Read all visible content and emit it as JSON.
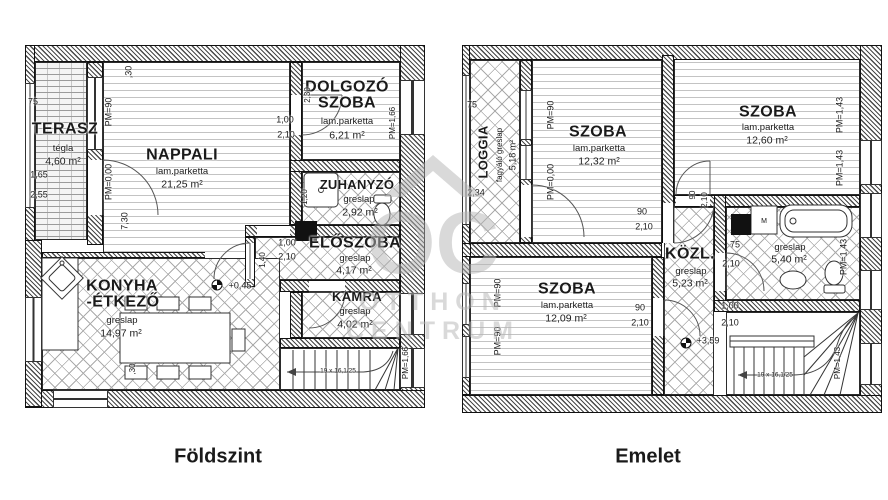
{
  "watermark": {
    "monogram": "OC",
    "line1": "OTTHON",
    "line2": "CENTRUM"
  },
  "floors": [
    {
      "title": "Földszint",
      "rooms": {
        "terasz": {
          "name": "TERASZ",
          "finish": "tégla",
          "area": "4,60 m²"
        },
        "nappali": {
          "name": "NAPPALI",
          "finish": "lam.parketta",
          "area": "21,25 m²"
        },
        "dolgozo": {
          "name1": "DOLGOZÓ",
          "name2": "SZOBA",
          "finish": "lam.parketta",
          "area": "6,21 m²"
        },
        "zuhanyzo": {
          "name": "ZUHANYZÓ",
          "finish": "greslap",
          "area": "2,92 m²"
        },
        "eloszoba": {
          "name": "ELŐSZOBA",
          "finish": "greslap",
          "area": "4,17 m²"
        },
        "kamra": {
          "name": "KAMRA",
          "finish": "greslap",
          "area": "4,02 m²"
        },
        "konyha": {
          "name1": "KONYHA",
          "name2": "-ÉTKEZŐ",
          "finish": "greslap",
          "area": "14,97 m²"
        }
      },
      "dims": {
        "pm90": "PM=90",
        "pm000": "PM=0,00",
        "pm166": "PM=1,66",
        "h730": "7,30",
        "w30": ",30",
        "d100": "1,00",
        "d210": "2,10",
        "d230": "2,30",
        "w120": "1,20",
        "w140": "1,40",
        "t75": "75",
        "t165": "1,65",
        "t255": "2,55",
        "lvl": "+0,45",
        "stair": "19 x 16,1/25"
      }
    },
    {
      "title": "Emelet",
      "rooms": {
        "loggia": {
          "name": "LOGGIA",
          "finish": "fagyáló greslap",
          "area": "5,18 m²"
        },
        "szoba_tl": {
          "name": "SZOBA",
          "finish": "lam.parketta",
          "area": "12,32 m²"
        },
        "szoba_tr": {
          "name": "SZOBA",
          "finish": "lam.parketta",
          "area": "12,60 m²"
        },
        "szoba_bl": {
          "name": "SZOBA",
          "finish": "lam.parketta",
          "area": "12,09 m²"
        },
        "kozl": {
          "name": "KÖZL.",
          "finish": "greslap",
          "area": "5,23 m²"
        },
        "furdo": {
          "finish": "greslap",
          "area": "5,40 m²"
        }
      },
      "dims": {
        "pm90": "PM=90",
        "pm000": "PM=0,00",
        "pm143": "PM=1,43",
        "d90": "90",
        "d210": "2,10",
        "d75": "75",
        "d100": "1,00",
        "t75": "75",
        "t234": "2,34",
        "lvl": "+3,59",
        "stair": "19 x 16,1/25"
      },
      "fixtures": {
        "washer": "M"
      }
    }
  ]
}
